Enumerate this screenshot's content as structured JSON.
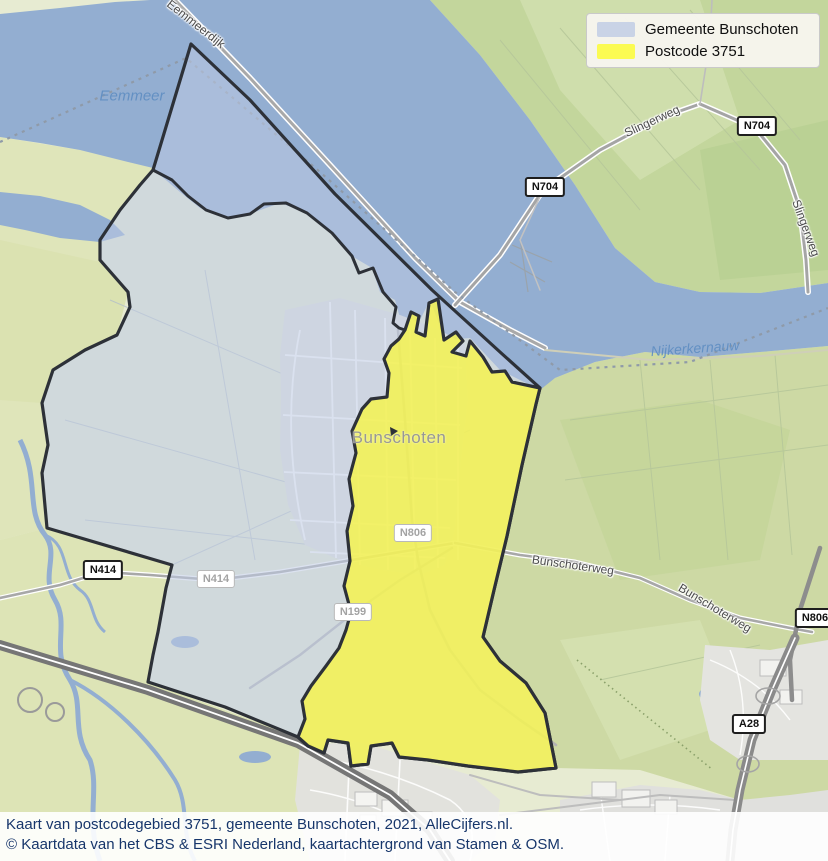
{
  "legend": {
    "items": [
      {
        "label": "Gemeente Bunschoten",
        "color": "#c9d3e6"
      },
      {
        "label": "Postcode 3751",
        "color": "#fbfb52"
      }
    ]
  },
  "caption": {
    "line1": "Kaart van postcodegebied 3751, gemeente Bunschoten, 2021, AlleCijfers.nl.",
    "line2": "© Kaartdata van het CBS & ESRI Nederland, kaartachtergrond van Stamen & OSM."
  },
  "map": {
    "place_labels": {
      "town": "Bunschoten"
    },
    "water_labels": {
      "eemmeer": "Eemmeer",
      "nijkerkernauw": "Nijkerkernauw"
    },
    "road_labels": {
      "eemmeerdijk": "Eemmeerdijk",
      "slingerweg": "Slingerweg",
      "slingerweg_edge": "Slingerweg",
      "bunschoterweg_a": "Bunschoterweg",
      "bunschoterweg_b": "Bunschoterweg"
    },
    "shields": {
      "n704_a": "N704",
      "n704_b": "N704",
      "n414_a": "N414",
      "n414_b": "N414",
      "n199": "N199",
      "n806_a": "N806",
      "n806_b": "N806",
      "a28": "A28"
    },
    "colors": {
      "water": "#93aed1",
      "gemeente_fill": "#becae4",
      "postcode_fill": "#f6f34a",
      "boundary": "#2d3138"
    }
  }
}
